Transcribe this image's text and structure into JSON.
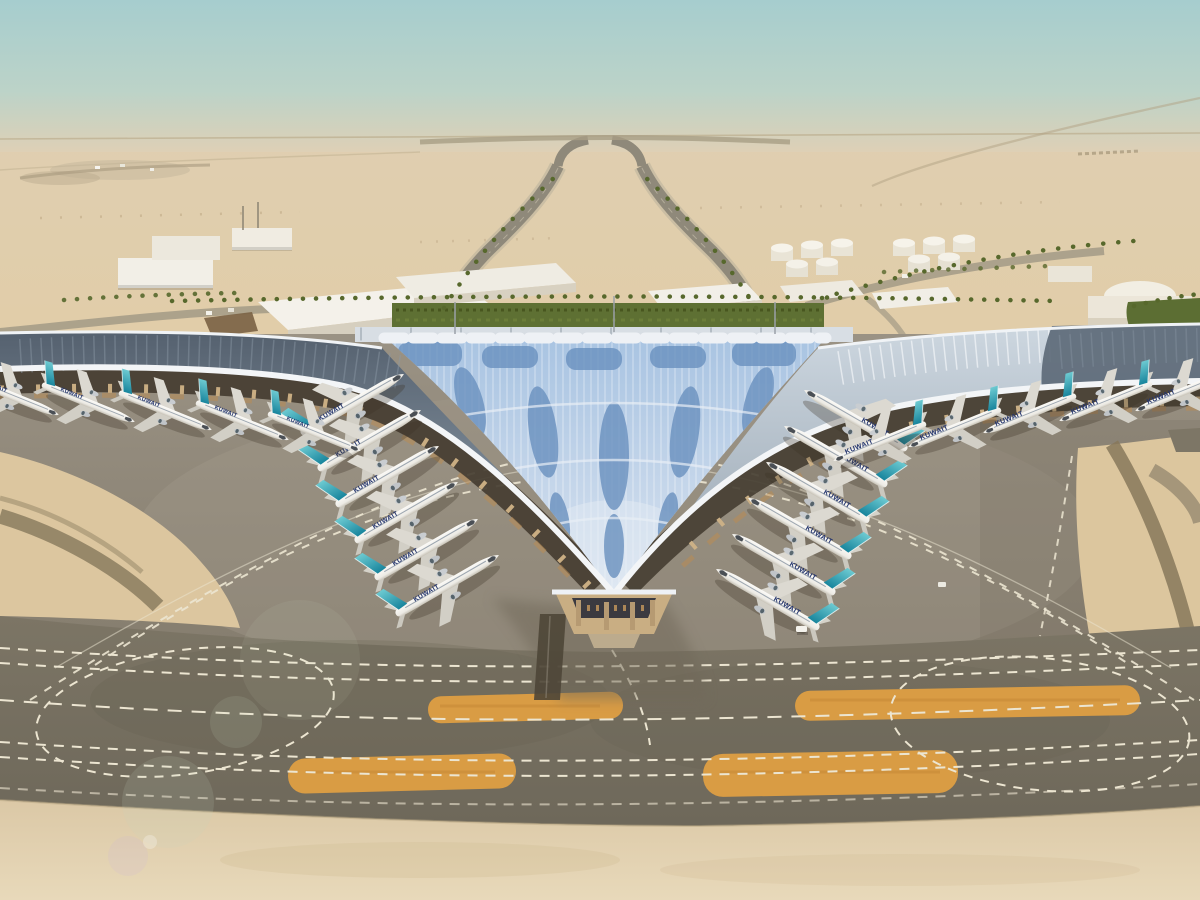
{
  "scene": {
    "setting": "aerial rendering of desert airport terminal",
    "aircraft": {
      "livery_label": "KUWAIT",
      "count": 22,
      "livery_text_color": "#24356e",
      "tail_color_top": "#6ecbd2",
      "tail_color_bottom": "#17849c"
    },
    "terminal": {
      "roof_glass_color": "#a9c4e2",
      "roof_glass_bottom": "#d9e3f0",
      "roof_chevron_color": "#6a90bf",
      "roof_edge_color": "#f3f5f7",
      "hedge_color": "#5e7033"
    },
    "ground": {
      "apron_top": "#9a9284",
      "apron_bottom": "#847c6d",
      "taxiway_top": "#7c7565",
      "taxiway_bottom": "#6e685a",
      "sand_color": "#dcc69f",
      "foreground_sand_top": "#dbc8a6",
      "foreground_sand_bottom": "#e8d9ba",
      "paint_island_color": "#d99c44",
      "marking_color": "#ece5d1"
    },
    "sky": {
      "top": "#a6cdce",
      "mid": "#bcd3c8",
      "horizon": "#ded0b6"
    }
  }
}
